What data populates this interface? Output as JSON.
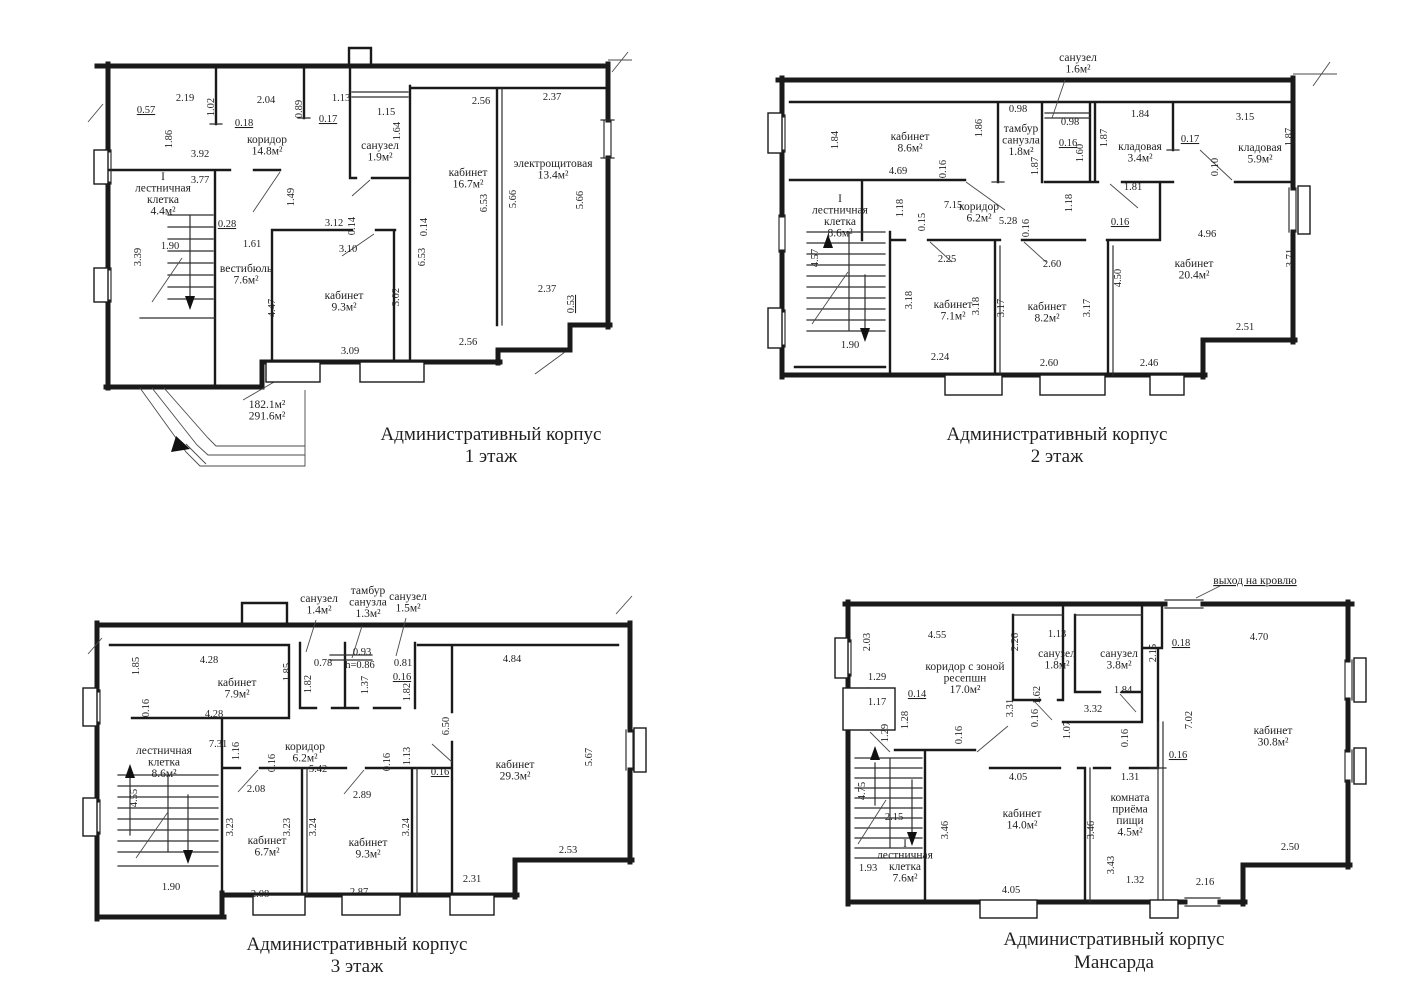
{
  "floors": [
    {
      "id": "floor-1",
      "title": "Административный корпус",
      "subtitle": "1 этаж",
      "rooms": [
        {
          "lines": [
            "коридор",
            "14.8м²"
          ],
          "x": 267,
          "y": 143
        },
        {
          "lines": [
            "санузел",
            "1.9м²"
          ],
          "x": 380,
          "y": 149
        },
        {
          "lines": [
            "кабинет",
            "16.7м²"
          ],
          "x": 468,
          "y": 176
        },
        {
          "lines": [
            "электрощитовая",
            "13.4м²"
          ],
          "x": 553,
          "y": 167
        },
        {
          "lines": [
            "I",
            "лестничная",
            "клетка",
            "4.4м²"
          ],
          "x": 163,
          "y": 180
        },
        {
          "lines": [
            "вестибюль",
            "7.6м²"
          ],
          "x": 246,
          "y": 272
        },
        {
          "lines": [
            "кабинет",
            "9.3м²"
          ],
          "x": 344,
          "y": 299
        },
        {
          "lines": [
            "182.1м²",
            "291.6м²"
          ],
          "x": 267,
          "y": 408
        }
      ],
      "dims": [
        {
          "t": "0.57",
          "x": 146,
          "y": 113,
          "u": 1
        },
        {
          "t": "2.19",
          "x": 185,
          "y": 101
        },
        {
          "t": "1.02",
          "x": 214,
          "y": 107,
          "v": 1
        },
        {
          "t": "0.18",
          "x": 244,
          "y": 126,
          "u": 1
        },
        {
          "t": "2.04",
          "x": 266,
          "y": 103
        },
        {
          "t": "0.89",
          "x": 302,
          "y": 109,
          "v": 1
        },
        {
          "t": "1.13",
          "x": 341,
          "y": 101
        },
        {
          "t": "0.17",
          "x": 328,
          "y": 122,
          "u": 1
        },
        {
          "t": "1.15",
          "x": 386,
          "y": 115
        },
        {
          "t": "1.64",
          "x": 400,
          "y": 131,
          "v": 1
        },
        {
          "t": "2.56",
          "x": 481,
          "y": 104
        },
        {
          "t": "2.37",
          "x": 552,
          "y": 100
        },
        {
          "t": "1.86",
          "x": 172,
          "y": 139,
          "v": 1
        },
        {
          "t": "3.92",
          "x": 200,
          "y": 157
        },
        {
          "t": "3.77",
          "x": 200,
          "y": 183
        },
        {
          "t": "1.49",
          "x": 294,
          "y": 197,
          "v": 1
        },
        {
          "t": "3.12",
          "x": 334,
          "y": 226
        },
        {
          "t": "0.14",
          "x": 355,
          "y": 226,
          "v": 1
        },
        {
          "t": "0.14",
          "x": 427,
          "y": 227,
          "v": 1
        },
        {
          "t": "6.53",
          "x": 487,
          "y": 203,
          "v": 1
        },
        {
          "t": "5.66",
          "x": 516,
          "y": 199,
          "v": 1
        },
        {
          "t": "5.66",
          "x": 583,
          "y": 200,
          "v": 1
        },
        {
          "t": "0.28",
          "x": 227,
          "y": 227,
          "u": 1
        },
        {
          "t": "3.39",
          "x": 141,
          "y": 257,
          "v": 1
        },
        {
          "t": "1.90",
          "x": 170,
          "y": 249
        },
        {
          "t": "1.61",
          "x": 252,
          "y": 247
        },
        {
          "t": "3.10",
          "x": 348,
          "y": 252
        },
        {
          "t": "6.53",
          "x": 425,
          "y": 257,
          "v": 1
        },
        {
          "t": "3.02",
          "x": 399,
          "y": 297,
          "v": 1
        },
        {
          "t": "4.47",
          "x": 275,
          "y": 308,
          "v": 1
        },
        {
          "t": "3.09",
          "x": 350,
          "y": 354
        },
        {
          "t": "2.56",
          "x": 468,
          "y": 345
        },
        {
          "t": "2.37",
          "x": 547,
          "y": 292
        },
        {
          "t": "0.53",
          "x": 574,
          "y": 304,
          "v": 1,
          "u": 1
        }
      ]
    },
    {
      "id": "floor-2",
      "title": "Административный корпус",
      "subtitle": "2 этаж",
      "rooms": [
        {
          "lines": [
            "санузел",
            "1.6м²"
          ],
          "x": 1078,
          "y": 61
        },
        {
          "lines": [
            "кабинет",
            "8.6м²"
          ],
          "x": 910,
          "y": 140
        },
        {
          "lines": [
            "тамбур",
            "санузла",
            "1.8м²"
          ],
          "x": 1021,
          "y": 132
        },
        {
          "lines": [
            "кладовая",
            "3.4м²"
          ],
          "x": 1140,
          "y": 150
        },
        {
          "lines": [
            "кладовая",
            "5.9м²"
          ],
          "x": 1260,
          "y": 151
        },
        {
          "lines": [
            "I",
            "лестничная",
            "клетка",
            "8.6м²"
          ],
          "x": 840,
          "y": 202
        },
        {
          "lines": [
            "коридор",
            "6.2м²"
          ],
          "x": 979,
          "y": 210
        },
        {
          "lines": [
            "кабинет",
            "7.1м²"
          ],
          "x": 953,
          "y": 308
        },
        {
          "lines": [
            "кабинет",
            "8.2м²"
          ],
          "x": 1047,
          "y": 310
        },
        {
          "lines": [
            "кабинет",
            "20.4м²"
          ],
          "x": 1194,
          "y": 267
        }
      ],
      "dims": [
        {
          "t": "1.84",
          "x": 838,
          "y": 140,
          "v": 1
        },
        {
          "t": "4.69",
          "x": 898,
          "y": 174
        },
        {
          "t": "0.16",
          "x": 946,
          "y": 169,
          "v": 1
        },
        {
          "t": "1.86",
          "x": 982,
          "y": 128,
          "v": 1
        },
        {
          "t": "0.98",
          "x": 1018,
          "y": 112
        },
        {
          "t": "0.98",
          "x": 1070,
          "y": 125
        },
        {
          "t": "0.16",
          "x": 1068,
          "y": 146,
          "u": 1
        },
        {
          "t": "1.60",
          "x": 1083,
          "y": 153,
          "v": 1
        },
        {
          "t": "1.87",
          "x": 1038,
          "y": 166,
          "v": 1
        },
        {
          "t": "1.87",
          "x": 1107,
          "y": 138,
          "v": 1
        },
        {
          "t": "1.84",
          "x": 1140,
          "y": 117
        },
        {
          "t": "0.17",
          "x": 1190,
          "y": 142,
          "u": 1
        },
        {
          "t": "3.15",
          "x": 1245,
          "y": 120
        },
        {
          "t": "1.87",
          "x": 1292,
          "y": 137,
          "v": 1
        },
        {
          "t": "0.10",
          "x": 1218,
          "y": 167,
          "v": 1
        },
        {
          "t": "1.18",
          "x": 903,
          "y": 208,
          "v": 1
        },
        {
          "t": "0.15",
          "x": 925,
          "y": 222,
          "v": 1
        },
        {
          "t": "7.15",
          "x": 953,
          "y": 208
        },
        {
          "t": "5.28",
          "x": 1008,
          "y": 224
        },
        {
          "t": "0.16",
          "x": 1029,
          "y": 228,
          "v": 1
        },
        {
          "t": "1.18",
          "x": 1072,
          "y": 203,
          "v": 1
        },
        {
          "t": "1.81",
          "x": 1133,
          "y": 190
        },
        {
          "t": "0.16",
          "x": 1120,
          "y": 225,
          "u": 1
        },
        {
          "t": "4.96",
          "x": 1207,
          "y": 237
        },
        {
          "t": "3.71",
          "x": 1293,
          "y": 258,
          "v": 1
        },
        {
          "t": "4.57",
          "x": 818,
          "y": 258,
          "v": 1
        },
        {
          "t": "2.25",
          "x": 947,
          "y": 262
        },
        {
          "t": "2.60",
          "x": 1052,
          "y": 267
        },
        {
          "t": "4.50",
          "x": 1121,
          "y": 278,
          "v": 1
        },
        {
          "t": "3.18",
          "x": 912,
          "y": 300,
          "v": 1
        },
        {
          "t": "3.18",
          "x": 979,
          "y": 306,
          "v": 1
        },
        {
          "t": "3.17",
          "x": 1004,
          "y": 308,
          "v": 1
        },
        {
          "t": "3.17",
          "x": 1090,
          "y": 308,
          "v": 1
        },
        {
          "t": "1.90",
          "x": 850,
          "y": 348
        },
        {
          "t": "2.24",
          "x": 940,
          "y": 360
        },
        {
          "t": "2.60",
          "x": 1049,
          "y": 366
        },
        {
          "t": "2.46",
          "x": 1149,
          "y": 366
        },
        {
          "t": "2.51",
          "x": 1245,
          "y": 330
        }
      ]
    },
    {
      "id": "floor-3",
      "title": "Административный корпус",
      "subtitle": "3 этаж",
      "rooms": [
        {
          "lines": [
            "санузел",
            "1.4м²"
          ],
          "x": 319,
          "y": 602
        },
        {
          "lines": [
            "тамбур",
            "санузла",
            "1.3м²"
          ],
          "x": 368,
          "y": 594
        },
        {
          "lines": [
            "санузел",
            "1.5м²"
          ],
          "x": 408,
          "y": 600
        },
        {
          "lines": [
            "кабинет",
            "7.9м²"
          ],
          "x": 237,
          "y": 686
        },
        {
          "lines": [
            "лестничная",
            "клетка",
            "8.6м²"
          ],
          "x": 164,
          "y": 754
        },
        {
          "lines": [
            "коридор",
            "6.2м²"
          ],
          "x": 305,
          "y": 750
        },
        {
          "lines": [
            "кабинет",
            "29.3м²"
          ],
          "x": 515,
          "y": 768
        },
        {
          "lines": [
            "кабинет",
            "6.7м²"
          ],
          "x": 267,
          "y": 844
        },
        {
          "lines": [
            "кабинет",
            "9.3м²"
          ],
          "x": 368,
          "y": 846
        }
      ],
      "dims": [
        {
          "t": "1.85",
          "x": 139,
          "y": 666,
          "v": 1
        },
        {
          "t": "4.28",
          "x": 209,
          "y": 663
        },
        {
          "t": "1.85",
          "x": 290,
          "y": 672,
          "v": 1
        },
        {
          "t": "0.78",
          "x": 323,
          "y": 666
        },
        {
          "t": "0.93",
          "x": 362,
          "y": 655
        },
        {
          "t": "h=0.86",
          "x": 360,
          "y": 668
        },
        {
          "t": "0.81",
          "x": 403,
          "y": 666
        },
        {
          "t": "0.16",
          "x": 402,
          "y": 680,
          "u": 1
        },
        {
          "t": "1.82",
          "x": 311,
          "y": 684,
          "v": 1
        },
        {
          "t": "1.37",
          "x": 368,
          "y": 685,
          "v": 1
        },
        {
          "t": "1.82",
          "x": 410,
          "y": 692,
          "v": 1
        },
        {
          "t": "4.84",
          "x": 512,
          "y": 662
        },
        {
          "t": "0.16",
          "x": 149,
          "y": 708,
          "v": 1
        },
        {
          "t": "4.28",
          "x": 214,
          "y": 717
        },
        {
          "t": "7.31",
          "x": 218,
          "y": 747
        },
        {
          "t": "1.16",
          "x": 239,
          "y": 751,
          "v": 1
        },
        {
          "t": "0.16",
          "x": 275,
          "y": 763,
          "v": 1
        },
        {
          "t": "5.42",
          "x": 318,
          "y": 772
        },
        {
          "t": "0.16",
          "x": 390,
          "y": 762,
          "v": 1
        },
        {
          "t": "1.13",
          "x": 410,
          "y": 756,
          "v": 1
        },
        {
          "t": "6.50",
          "x": 449,
          "y": 726,
          "v": 1
        },
        {
          "t": "0.16",
          "x": 440,
          "y": 775,
          "u": 1
        },
        {
          "t": "5.67",
          "x": 592,
          "y": 757,
          "v": 1
        },
        {
          "t": "4.55",
          "x": 137,
          "y": 798,
          "v": 1
        },
        {
          "t": "2.08",
          "x": 256,
          "y": 792
        },
        {
          "t": "2.89",
          "x": 362,
          "y": 798
        },
        {
          "t": "3.23",
          "x": 233,
          "y": 827,
          "v": 1
        },
        {
          "t": "3.23",
          "x": 290,
          "y": 827,
          "v": 1
        },
        {
          "t": "3.24",
          "x": 316,
          "y": 827,
          "v": 1
        },
        {
          "t": "3.24",
          "x": 409,
          "y": 827,
          "v": 1
        },
        {
          "t": "1.90",
          "x": 171,
          "y": 890
        },
        {
          "t": "2.08",
          "x": 260,
          "y": 897
        },
        {
          "t": "2.87",
          "x": 359,
          "y": 895
        },
        {
          "t": "2.31",
          "x": 472,
          "y": 882
        },
        {
          "t": "2.53",
          "x": 568,
          "y": 853
        }
      ]
    },
    {
      "id": "floor-mansard",
      "title": "Административный корпус",
      "subtitle": "Мансарда",
      "rooms": [
        {
          "lines": [
            "выход на кровлю"
          ],
          "x": 1255,
          "y": 584,
          "u": 1
        },
        {
          "lines": [
            "коридор с зоной",
            "ресепшн",
            "17.0м²"
          ],
          "x": 965,
          "y": 670
        },
        {
          "lines": [
            "санузел",
            "1.8м²"
          ],
          "x": 1057,
          "y": 657
        },
        {
          "lines": [
            "санузел",
            "3.8м²"
          ],
          "x": 1119,
          "y": 657
        },
        {
          "lines": [
            "кабинет",
            "30.8м²"
          ],
          "x": 1273,
          "y": 734
        },
        {
          "lines": [
            "кабинет",
            "14.0м²"
          ],
          "x": 1022,
          "y": 817
        },
        {
          "lines": [
            "комната",
            "приёма",
            "пищи",
            "4.5м²"
          ],
          "x": 1130,
          "y": 801
        },
        {
          "lines": [
            "I",
            "лестничная",
            "клетка",
            "7.6м²"
          ],
          "x": 905,
          "y": 847
        }
      ],
      "dims": [
        {
          "t": "2.03",
          "x": 870,
          "y": 642,
          "v": 1
        },
        {
          "t": "4.55",
          "x": 937,
          "y": 638
        },
        {
          "t": "2.26",
          "x": 1018,
          "y": 642,
          "v": 1
        },
        {
          "t": "1.13",
          "x": 1057,
          "y": 637
        },
        {
          "t": "0.18",
          "x": 1181,
          "y": 646,
          "u": 1
        },
        {
          "t": "2.15",
          "x": 1156,
          "y": 653,
          "v": 1
        },
        {
          "t": "4.70",
          "x": 1259,
          "y": 640
        },
        {
          "t": "1.29",
          "x": 877,
          "y": 680
        },
        {
          "t": "0.14",
          "x": 917,
          "y": 697,
          "u": 1
        },
        {
          "t": "1.17",
          "x": 877,
          "y": 705
        },
        {
          "t": "1.28",
          "x": 908,
          "y": 720,
          "v": 1
        },
        {
          "t": "1.29",
          "x": 888,
          "y": 733,
          "v": 1
        },
        {
          "t": "3.31",
          "x": 1013,
          "y": 708,
          "v": 1
        },
        {
          "t": "0.16",
          "x": 962,
          "y": 735,
          "v": 1
        },
        {
          "t": "1.62",
          "x": 1040,
          "y": 695,
          "v": 1
        },
        {
          "t": "0.16",
          "x": 1038,
          "y": 718,
          "v": 1
        },
        {
          "t": "1.07",
          "x": 1070,
          "y": 730,
          "v": 1
        },
        {
          "t": "3.32",
          "x": 1093,
          "y": 712
        },
        {
          "t": "1.84",
          "x": 1123,
          "y": 693
        },
        {
          "t": "7.02",
          "x": 1192,
          "y": 720,
          "v": 1
        },
        {
          "t": "0.16",
          "x": 1128,
          "y": 738,
          "v": 1
        },
        {
          "t": "0.16",
          "x": 1178,
          "y": 758,
          "u": 1
        },
        {
          "t": "4.05",
          "x": 1018,
          "y": 780
        },
        {
          "t": "1.31",
          "x": 1130,
          "y": 780
        },
        {
          "t": "4.75",
          "x": 865,
          "y": 791,
          "v": 1
        },
        {
          "t": "2.15",
          "x": 894,
          "y": 820
        },
        {
          "t": "3.46",
          "x": 948,
          "y": 830,
          "v": 1
        },
        {
          "t": "3.46",
          "x": 1094,
          "y": 830,
          "v": 1
        },
        {
          "t": "3.43",
          "x": 1114,
          "y": 865,
          "v": 1
        },
        {
          "t": "1.93",
          "x": 868,
          "y": 871
        },
        {
          "t": "2.50",
          "x": 1290,
          "y": 850
        },
        {
          "t": "4.05",
          "x": 1011,
          "y": 893
        },
        {
          "t": "1.32",
          "x": 1135,
          "y": 883
        },
        {
          "t": "2.16",
          "x": 1205,
          "y": 885
        }
      ]
    }
  ]
}
